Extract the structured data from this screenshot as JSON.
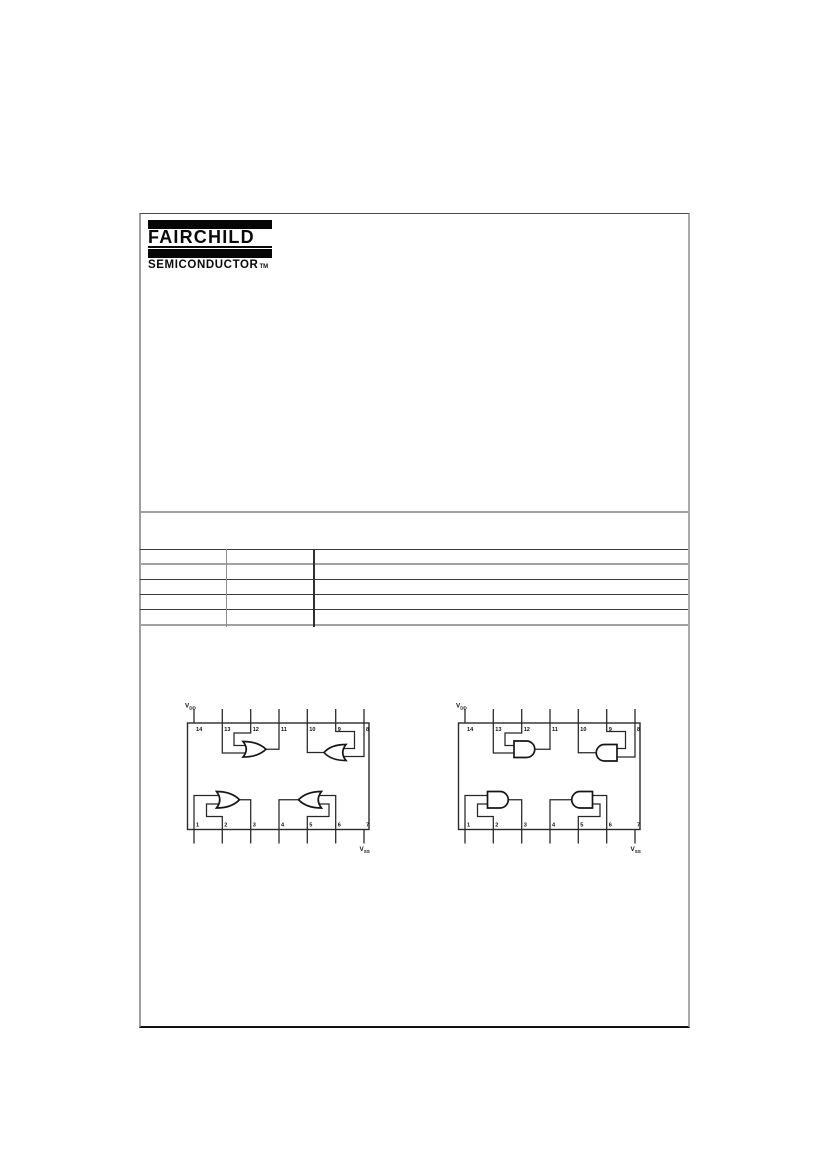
{
  "logo": {
    "brand": "FAIRCHILD",
    "division": "SEMICONDUCTOR",
    "trademark": "TM"
  },
  "colors": {
    "ink": "#0a0a0a",
    "rule_gray": "#a2a2a2",
    "rule_dark": "#3a3a3a"
  },
  "table": {
    "columns": 3,
    "rows": [
      [
        "",
        "",
        ""
      ],
      [
        "",
        "",
        ""
      ],
      [
        "",
        "",
        ""
      ],
      [
        "",
        "",
        ""
      ],
      [
        "",
        "",
        ""
      ]
    ]
  },
  "diagrams": [
    {
      "name": "quad-2-input-or-gate-connection-diagram",
      "gate_type": "OR",
      "top_pins": [
        "14",
        "13",
        "12",
        "11",
        "10",
        "9",
        "8"
      ],
      "bottom_pins": [
        "1",
        "2",
        "3",
        "4",
        "5",
        "6",
        "7"
      ],
      "vdd_label": {
        "main": "V",
        "sub": "DD"
      },
      "vss_label": {
        "main": "V",
        "sub": "SS"
      },
      "gates": [
        {
          "inputs": [
            "13",
            "12"
          ],
          "output": "11"
        },
        {
          "inputs": [
            "9",
            "8"
          ],
          "output": "10"
        },
        {
          "inputs": [
            "1",
            "2"
          ],
          "output": "3"
        },
        {
          "inputs": [
            "5",
            "6"
          ],
          "output": "4"
        }
      ]
    },
    {
      "name": "quad-2-input-and-gate-connection-diagram",
      "gate_type": "AND",
      "top_pins": [
        "14",
        "13",
        "12",
        "11",
        "10",
        "9",
        "8"
      ],
      "bottom_pins": [
        "1",
        "2",
        "3",
        "4",
        "5",
        "6",
        "7"
      ],
      "vdd_label": {
        "main": "V",
        "sub": "DD"
      },
      "vss_label": {
        "main": "V",
        "sub": "SS"
      },
      "gates": [
        {
          "inputs": [
            "13",
            "12"
          ],
          "output": "11"
        },
        {
          "inputs": [
            "9",
            "8"
          ],
          "output": "10"
        },
        {
          "inputs": [
            "1",
            "2"
          ],
          "output": "3"
        },
        {
          "inputs": [
            "5",
            "6"
          ],
          "output": "4"
        }
      ]
    }
  ]
}
